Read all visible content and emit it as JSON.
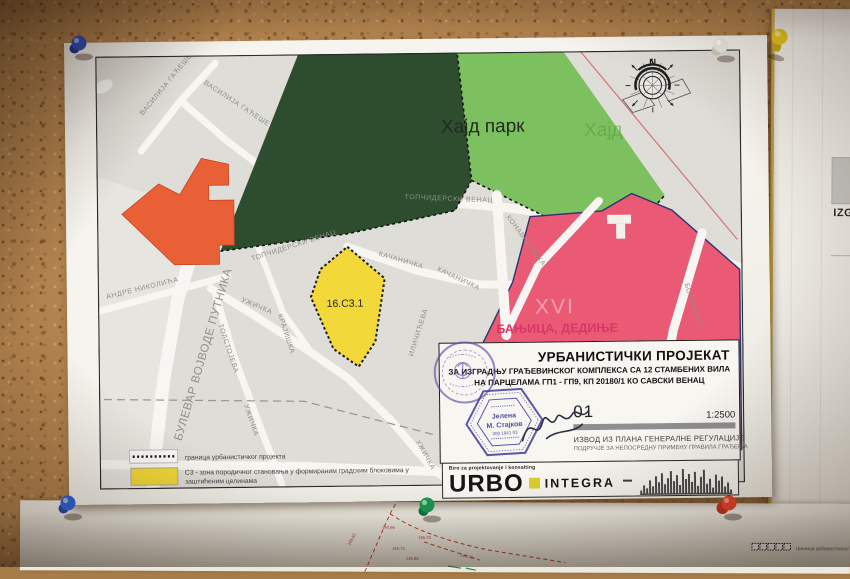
{
  "map": {
    "labels": {
      "park": "Хајд парк",
      "park_faint": "Хајд",
      "district_numeral": "XVI",
      "district_name": "БАЊИЦА, ДЕДИЊЕ",
      "zone_code": "16.С3.1",
      "compass_north": "N"
    },
    "streets": {
      "bulevar": "БУЛЕВАР ВОЈВОДЕ ПУТНИКА",
      "topciderski": "ТОПЧИДЕРСКИ ВЕНАЦ",
      "vasilija": "ВАСИЛИЈА ГАЋЕШЕ",
      "andre": "АНДРЕ НИКОЛИЋА",
      "uzicka": "УЖИЧКА",
      "tolstojeva": "ТОЛСТОЈЕВА",
      "krajiska": "КРАЈИШКА",
      "kacanicka": "КАЧАНИЧКА",
      "konavljanska": "КОНАВЉАНСКА",
      "boticeva": "БОТИЋЕВА",
      "ilicica": "ИЛИЧИЋЕВА"
    },
    "colors": {
      "park_dark": "#2e4d2f",
      "park_light": "#7dc05f",
      "zone_yellow": "#f2d838",
      "complex_orange": "#e95f36",
      "district_pink": "#ea5a74",
      "boundary_navy": "#2b3470",
      "boundary_red": "#d47a78",
      "district_text": "#d63768",
      "district_numeral_text": "#ee9db4"
    }
  },
  "legend": {
    "boundary_label": "граница урбанистичког пројекта",
    "zone_line1": "С3 - зона породичног становања у формираним градским блоковима у",
    "zone_line2": "заштићеним целинама"
  },
  "title_block": {
    "title": "УРБАНИСТИЧКИ ПРОЈЕКАТ",
    "subtitle1": "ЗА ИЗГРАДЊУ ГРАЂЕВИНСКОГ КОМПЛЕКСА СА 12 СТАМБЕНИХ ВИЛА",
    "subtitle2": "НА ПАРЦЕЛАМА ГП1 - ГП9,  КП 20180/1 КО САВСКИ ВЕНАЦ",
    "sheet_number": "01",
    "scale": "1:2500",
    "source1": "ИЗВОД ИЗ ПЛАНА ГЕНЕРАЛНЕ РЕГУЛАЦИЈЕ",
    "source2": "ПОДРУЧЈЕ ЗА НЕПОСРЕДНУ ПРИМЕНУ ПРАВИЛА ГРАЂЕЊА",
    "stamp": {
      "name1": "Јелена",
      "name2": "М. Стајков",
      "license": "300 1941 03"
    }
  },
  "logo": {
    "tagline": "Biro za projektovanje i konsalting",
    "brand": "URBO",
    "integra": "INTEGRA",
    "accent_color": "#d9cf2e"
  },
  "side_sheet": {
    "caption": "IZG"
  },
  "bottom_sheet": {
    "legend_caption": "граница урбанистичког пр",
    "elevations": [
      "145.62",
      "145.66",
      "146.75",
      "145.73",
      "145.88",
      "146.76"
    ]
  },
  "pins": {
    "blue_tl": {
      "color": "#2b4fc0"
    },
    "white_tr": {
      "color": "#efece2"
    },
    "yellow_r": {
      "color": "#e7c81f"
    },
    "blue_bl": {
      "color": "#2f62d9"
    },
    "green_b": {
      "color": "#1f9350"
    },
    "red_br": {
      "color": "#e8402a"
    }
  }
}
